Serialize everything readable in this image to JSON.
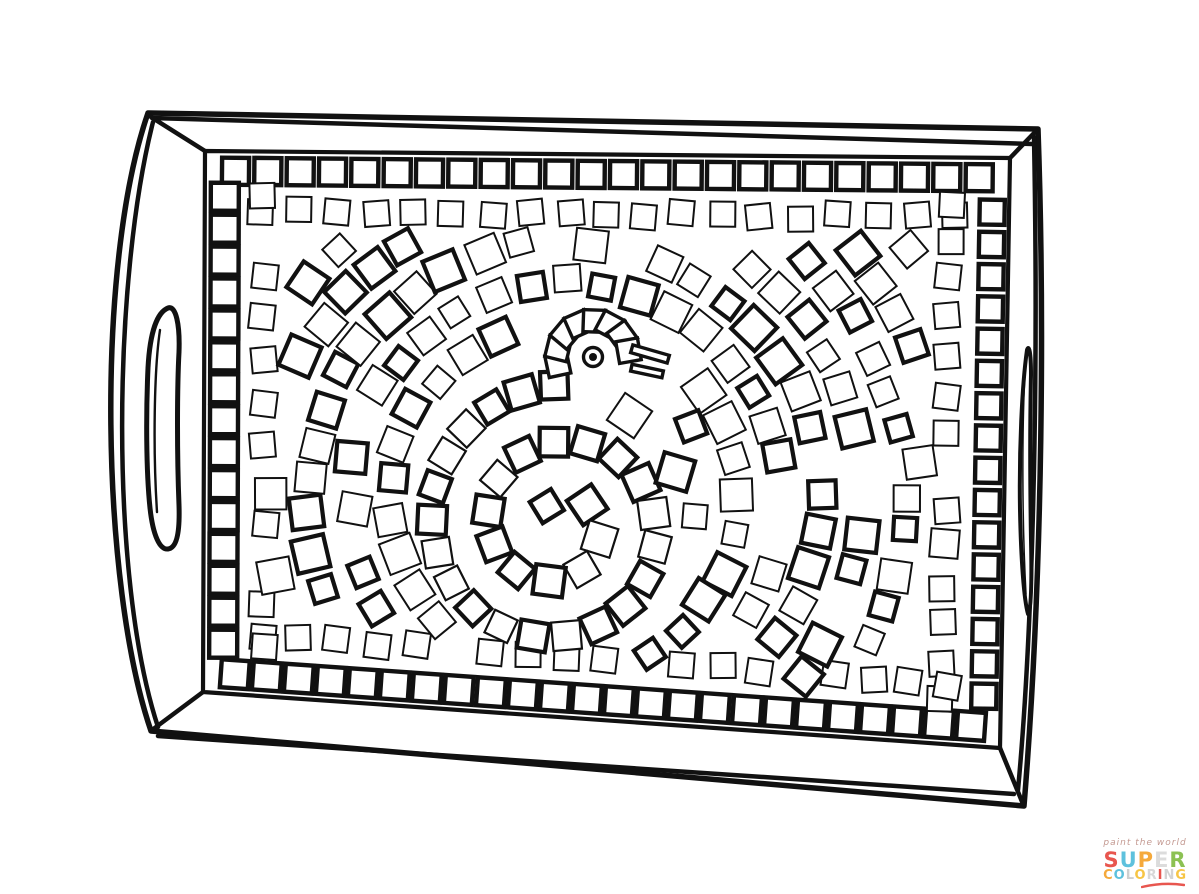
{
  "page": {
    "width": 1199,
    "height": 894,
    "background": "#ffffff",
    "ink": "#111111"
  },
  "tray": {
    "outer_path": "M 148,113 L 1038,129 C 1044,300 1044,560 1024,806 L 151,731 C 101,585 95,266 148,113 Z",
    "top_bevel": "M 152,118 L 1032,144",
    "bottom_bevel": "M 158,736 L 1014,794",
    "left_bevel": "M 153,122 C 113,280 109,578 158,727",
    "right_bevel": "M 1034,137 C 1039,400 1032,640 1018,790",
    "corner_lines": [
      "M 205,151 L 151,117",
      "M 1010,158 L 1036,131",
      "M 1000,748 L 1023,804",
      "M 203,692 L 152,730"
    ],
    "inner_quad": "M 205,151 L 1010,158 L 1000,748 L 203,692 Z",
    "left_handle_outline": "M 168,308 C 158,312 150,330 148,368 C 146,412 146,470 150,508 C 153,536 160,550 168,549 C 176,548 180,535 179,505 C 177,455 177,390 179,352 C 180,325 176,305 168,308 Z",
    "left_handle_inner": "M 160,330 C 154,370 153,450 157,512",
    "right_handle_outline": "M 1027,350 C 1022,385 1019,450 1020,510 C 1021,560 1024,600 1028,614 C 1031,612 1032,585 1031,540 C 1030,480 1030,420 1031,375 C 1031,352 1029,344 1027,350 Z",
    "right_handle_inner": "M 1025,372 C 1022,430 1022,520 1026,594"
  },
  "mosaic": {
    "seed": 11,
    "field_quad": [
      [
        205,
        151
      ],
      [
        1010,
        158
      ],
      [
        1000,
        748
      ],
      [
        203,
        692
      ]
    ],
    "collision_dist": 30,
    "border": {
      "stroke": 4.4,
      "rows": [
        {
          "edge": 0,
          "count": 24,
          "offset": 20,
          "size": 27,
          "t0": 0.018,
          "t1": 0.982
        },
        {
          "edge": 1,
          "count": 16,
          "offset": 17,
          "size": 25,
          "t0": 0.065,
          "t1": 0.94
        },
        {
          "edge": 2,
          "count": 24,
          "offset": 20,
          "size": 28,
          "t0": 0.018,
          "t1": 0.982
        },
        {
          "edge": 3,
          "count": 15,
          "offset": 20,
          "size": 28,
          "t0": 0.06,
          "t1": 0.945
        }
      ]
    },
    "ring2": {
      "offset": 60,
      "size": 25,
      "spacing": 39,
      "stroke": 2,
      "skip": 0.14,
      "rot_jitter": 7,
      "margin": 0.045
    },
    "rings": {
      "center": [
        565,
        498
      ],
      "r_start": 175,
      "r_step": 41,
      "r_max": 560,
      "spacing": 38,
      "size": 28,
      "size_jitter": 5,
      "inset": 56,
      "skip": 0.07,
      "bold_prob": 0.45,
      "stroke_bold": 4.2,
      "stroke_light": 2
    },
    "scatter": {
      "step": 46,
      "inset": 50,
      "size_min": 23,
      "size_max": 33,
      "skip": 0.2,
      "bold_prob": 0.35,
      "stroke_bold": 4.2,
      "stroke_light": 2
    }
  },
  "bird": {
    "spiral": {
      "center": [
        558,
        525
      ],
      "r0": 22,
      "k": 9.0,
      "r_max": 140,
      "phi0": 4.178,
      "step": 33,
      "size": 27,
      "bold_prob": 0.5,
      "stroke_bold": 4.2,
      "stroke_light": 2.2
    },
    "head_fan": {
      "center": [
        593,
        357
      ],
      "radius": 36,
      "size": 22,
      "stroke": 3.4,
      "angles": [
        168,
        194,
        220,
        246,
        272,
        298,
        324,
        350
      ]
    },
    "eye": {
      "center": [
        593,
        357
      ],
      "outer_r": 9.5,
      "dot_r": 4,
      "stroke": 3.4
    },
    "beak": [
      {
        "cx": 650,
        "cy": 354,
        "w": 38,
        "h": 8,
        "rot": 16,
        "stroke": 3.4
      },
      {
        "cx": 647,
        "cy": 371,
        "w": 32,
        "h": 7,
        "rot": 12,
        "stroke": 3.4
      }
    ],
    "block_points": [
      [
        650,
        354
      ],
      [
        647,
        371
      ],
      [
        664,
        358
      ],
      [
        633,
        351
      ],
      [
        633,
        369
      ],
      [
        593,
        357
      ],
      [
        593,
        372
      ],
      [
        575,
        345
      ],
      [
        612,
        338
      ]
    ]
  },
  "logo": {
    "tagline": "paint the world",
    "tagline_color": "#c49a92",
    "super_letters": [
      [
        "S",
        "#e8564f"
      ],
      [
        "U",
        "#5ec1dd"
      ],
      [
        "P",
        "#f5a93b"
      ],
      [
        "E",
        "#dcdcdc"
      ],
      [
        "R",
        "#8cc153"
      ]
    ],
    "coloring_letters": [
      [
        "C",
        "#f5a93b"
      ],
      [
        "O",
        "#5ec1dd"
      ],
      [
        "L",
        "#cfcfcf"
      ],
      [
        "O",
        "#f7c544"
      ],
      [
        "R",
        "#d8d8d8"
      ],
      [
        "I",
        "#e8564f"
      ],
      [
        "N",
        "#d3d3d3"
      ],
      [
        "G",
        "#f7c544"
      ]
    ],
    "swash_color": "#e8564f"
  }
}
